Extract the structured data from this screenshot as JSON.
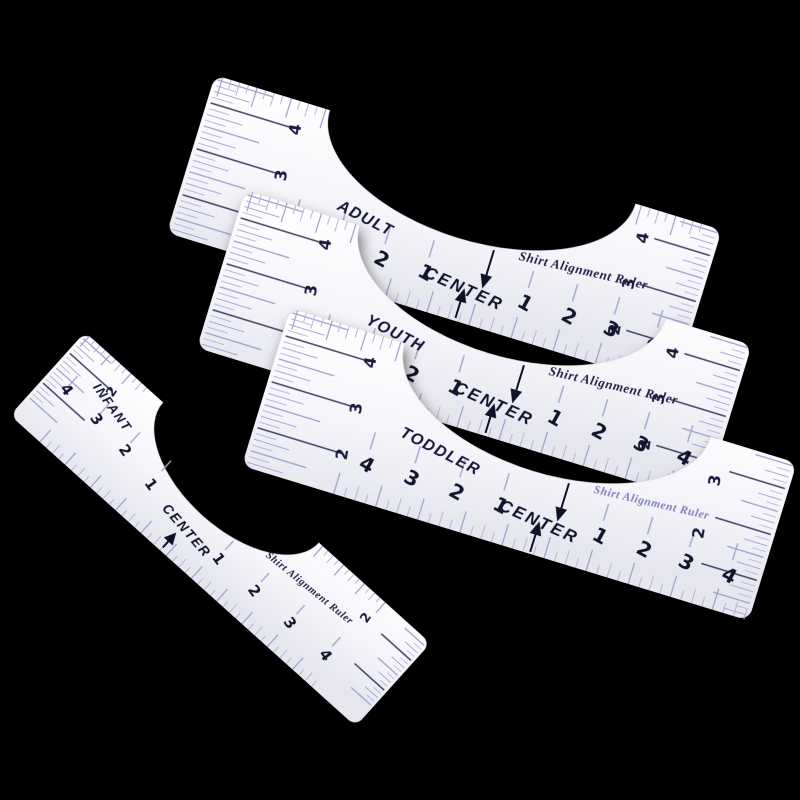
{
  "photo": {
    "background_color": "#000000"
  },
  "rulers": [
    {
      "id": "adult",
      "label": "ADULT",
      "center_label": "CENTER",
      "brand_text": "Shirt Alignment Ruler",
      "left_numbers": [
        "4",
        "3",
        "2",
        "1"
      ],
      "right_numbers": [
        "1",
        "2",
        "3",
        "4"
      ],
      "left_scale_labels": [
        "4",
        "3",
        "2"
      ],
      "right_scale_labels": [
        "4",
        "3",
        "2"
      ],
      "ink_color": "#12122c",
      "brand_color": "#1e1e40",
      "tick_color": "#9c9cd0"
    },
    {
      "id": "youth",
      "label": "YOUTH",
      "center_label": "CENTER",
      "brand_text": "Shirt Alignment Ruler",
      "left_numbers": [
        "4",
        "3",
        "2",
        "1"
      ],
      "right_numbers": [
        "1",
        "2",
        "3",
        "4"
      ],
      "left_scale_labels": [
        "4",
        "3",
        "2"
      ],
      "right_scale_labels": [
        "4",
        "3",
        "2"
      ],
      "ink_color": "#12122c",
      "brand_color": "#1e1e40",
      "tick_color": "#9c9cd0"
    },
    {
      "id": "toddler",
      "label": "TODDLER",
      "center_label": "CENTER",
      "brand_text": "Shirt Alignment Ruler",
      "left_numbers": [
        "4",
        "3",
        "2",
        "1"
      ],
      "right_numbers": [
        "1",
        "2",
        "3",
        "4"
      ],
      "left_scale_labels": [
        "4",
        "3",
        "2"
      ],
      "right_scale_labels": [
        "3",
        "2"
      ],
      "ink_color": "#12122c",
      "brand_color": "#7d7dbe",
      "tick_color": "#9c9cd0"
    },
    {
      "id": "infant",
      "label": "INFANT",
      "center_label": "CENTER",
      "brand_text": "Shirt Alignment Ruler",
      "left_numbers": [
        "4",
        "3",
        "2",
        "1"
      ],
      "right_numbers": [
        "1",
        "2",
        "3",
        "4"
      ],
      "left_scale_labels": [
        "2"
      ],
      "right_scale_labels": [
        "2"
      ],
      "ink_color": "#12122c",
      "brand_color": "#1e1e40",
      "tick_color": "#9c9cd0"
    }
  ]
}
